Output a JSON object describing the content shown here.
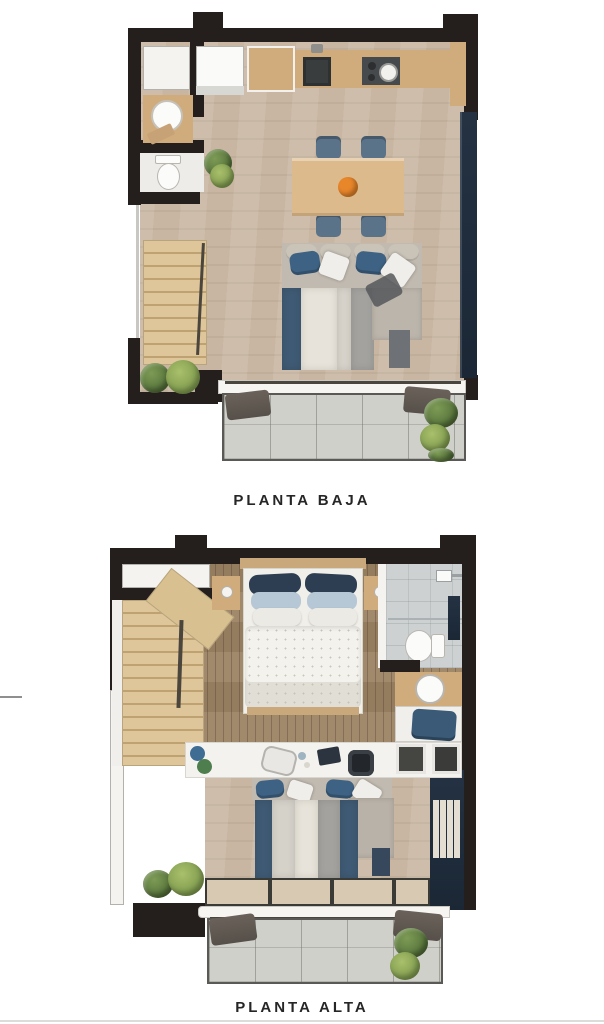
{
  "plans": {
    "baja": {
      "label": "PLANTA BAJA",
      "features": [
        "kitchen-counter-with-sink-and-stove",
        "washer",
        "tall-cabinet",
        "guest-wc-basin",
        "toilet",
        "dining-table-with-four-chairs",
        "corner-sofa",
        "striped-rug",
        "staircase",
        "sliding-window",
        "balcony-with-plants"
      ]
    },
    "alta": {
      "label": "PLANTA ALTA",
      "features": [
        "double-bed-with-nightstands",
        "bathroom-with-shower-and-toilet",
        "vanity-basin",
        "bench-with-cushion",
        "desk-with-chairs",
        "bookshelf-wall",
        "void-over-living-room",
        "staircase",
        "balcony-with-plants"
      ]
    }
  },
  "colors": {
    "wall": "#241f1c",
    "floor-light": "#c8b6a2",
    "floor-dark": "#9c8364",
    "wood-counter": "#d0ab7c",
    "wood-table": "#ddba8b",
    "chair-blue": "#5a7389",
    "sofa-gray": "#c1bab0",
    "pillow-blue": "#3e6283",
    "pillow-white": "#f0eeea",
    "rug-navy": "#3f5a74",
    "rug-cream": "#e7e3da",
    "rug-gray": "#a3a29e",
    "window-navy": "#1b2735",
    "balcony-floor": "#d0d0ca",
    "awning": "#57504a",
    "plant-green": "#7d9b55",
    "plant-dark": "#44602f",
    "tile-bath": "#cdd1d2",
    "accent-orange": "#e8862a",
    "label-color": "#262626"
  }
}
